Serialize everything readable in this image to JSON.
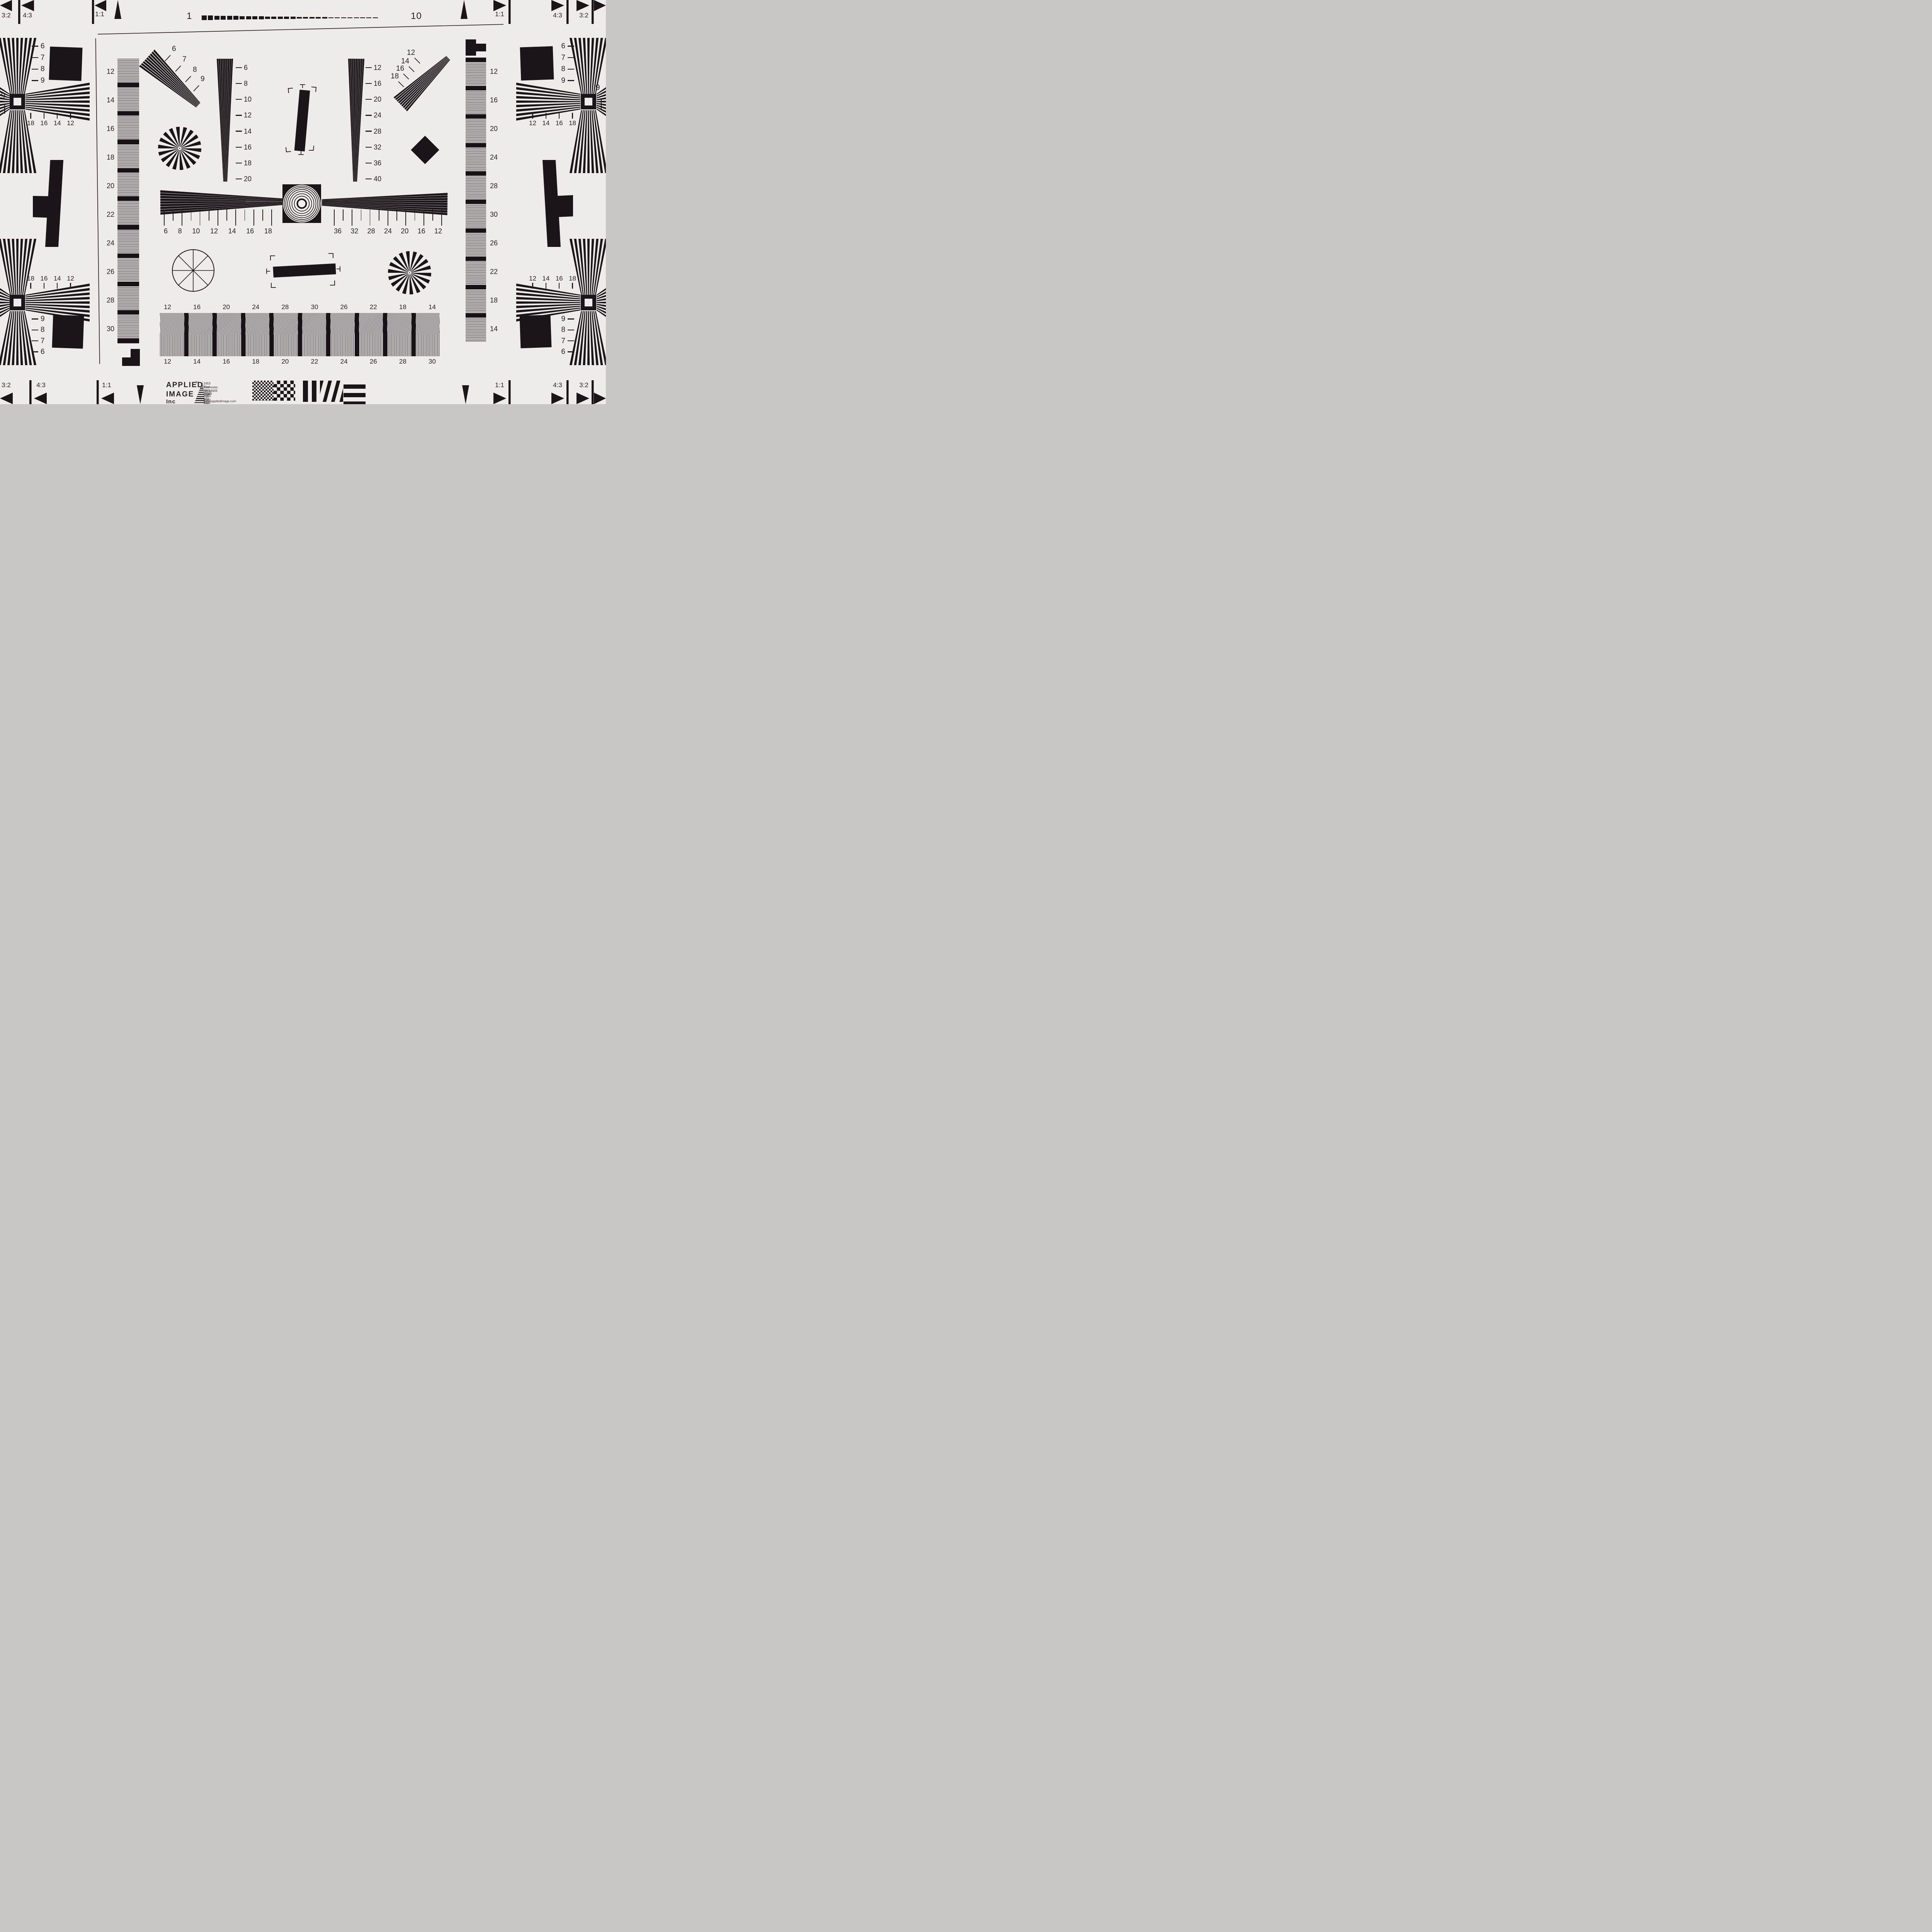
{
  "scale_bar": {
    "start": "1",
    "end": "10"
  },
  "corner_flags": {
    "top_left": [
      "3:2",
      "4:3",
      "1:1"
    ],
    "top_right": [
      "1:1",
      "4:3",
      "3:2"
    ],
    "bottom_left": [
      "3:2",
      "4:3",
      "1:1"
    ],
    "bottom_right": [
      "1:1",
      "4:3",
      "3:2"
    ]
  },
  "edge_marks": {
    "left": "9",
    "right": "9"
  },
  "quadrants": {
    "top_left": {
      "vertical": [
        "6",
        "7",
        "8",
        "9"
      ],
      "horizontal": [
        "18",
        "16",
        "14",
        "12"
      ]
    },
    "top_right": {
      "vertical": [
        "6",
        "7",
        "8",
        "9"
      ],
      "horizontal": [
        "12",
        "14",
        "16",
        "18"
      ]
    },
    "bottom_left": {
      "vertical": [
        "9",
        "8",
        "7",
        "6"
      ],
      "horizontal": [
        "18",
        "16",
        "14",
        "12"
      ]
    },
    "bottom_right": {
      "vertical": [
        "9",
        "8",
        "7",
        "6"
      ],
      "horizontal": [
        "12",
        "14",
        "16",
        "18"
      ]
    }
  },
  "wedges": {
    "diag_top_left": [
      "6",
      "7",
      "8",
      "9"
    ],
    "diag_top_right": [
      "12",
      "14",
      "16",
      "18"
    ],
    "left_vertical": [
      "6",
      "8",
      "10",
      "12",
      "14",
      "16",
      "18",
      "20"
    ],
    "right_vertical": [
      "12",
      "16",
      "20",
      "24",
      "28",
      "32",
      "36",
      "40"
    ],
    "center_left": [
      "6",
      "8",
      "10",
      "12",
      "14",
      "16",
      "18"
    ],
    "center_right": [
      "36",
      "32",
      "28",
      "24",
      "20",
      "16",
      "12"
    ]
  },
  "strips": {
    "left": [
      "12",
      "14",
      "16",
      "18",
      "20",
      "22",
      "24",
      "26",
      "28",
      "30"
    ],
    "right": [
      "12",
      "16",
      "20",
      "24",
      "28",
      "30",
      "26",
      "22",
      "18",
      "14"
    ],
    "bottom_top": [
      "12",
      "16",
      "20",
      "24",
      "28",
      "30",
      "26",
      "22",
      "18",
      "14"
    ],
    "bottom_bottom": [
      "12",
      "14",
      "16",
      "18",
      "20",
      "22",
      "24",
      "26",
      "28",
      "30"
    ]
  },
  "footer": {
    "company_1": "APPLIED",
    "registered": "®",
    "company_2": "IMAGE",
    "company_3": "Inc",
    "address_1": "1653 East Main Street",
    "address_2": "Rochester, NY  14609  USA",
    "voice": "Voice:   (585) 482-0300",
    "fax": "Fax:      (585) 288-5989",
    "web": "www.appliedimage.com"
  },
  "colors": {
    "background": "#edecea",
    "ink": "#1b1418",
    "patch_gray": "#a7a1a3"
  }
}
